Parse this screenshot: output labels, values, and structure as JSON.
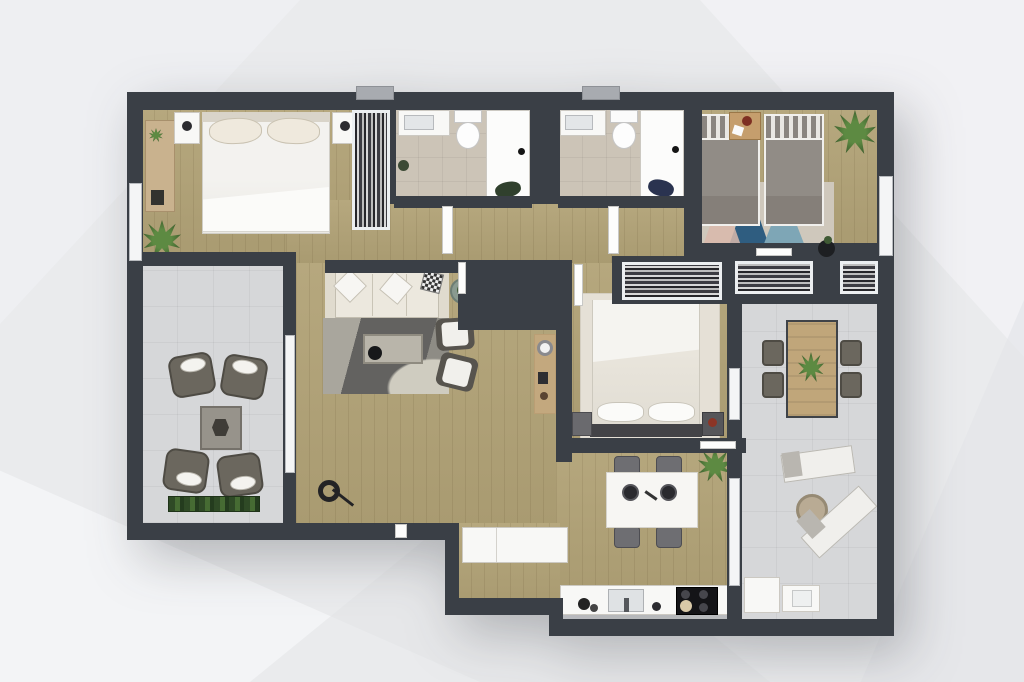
{
  "scene": {
    "title": "Apartment floor plan – top-down 3D render",
    "background_style": "light gray polygonal backdrop",
    "visible_text": "none"
  },
  "palette": {
    "background": "#eaebed",
    "wall": "#3a3f46",
    "wood_floor": "#b2a377",
    "bathroom_tile": "#ccc4b7",
    "balcony_tile": "#d6d7d9",
    "furniture_white": "#f8f8f6",
    "sofa_cream": "#ece8de",
    "bed_gray": "#918c86",
    "accent_red": "#8c3526",
    "plant_green": "#4a7a3a",
    "rug_dark_gray": "#636260",
    "rug_blue": "#2f5d80",
    "rug_teal": "#7ea6b6",
    "rug_pink": "#d9b9ab",
    "kitchen_cooktop": "#141417"
  },
  "rooms": [
    {
      "id": "master-bedroom",
      "name": "Master bedroom",
      "floor": "wood",
      "furniture": [
        "double bed",
        "two nightstands with lamps",
        "desk",
        "potted plant",
        "wardrobe"
      ]
    },
    {
      "id": "bathroom-1",
      "name": "Bathroom 1",
      "floor": "beige tile",
      "furniture": [
        "sink",
        "toilet",
        "shower"
      ]
    },
    {
      "id": "bathroom-2",
      "name": "Bathroom 2",
      "floor": "beige tile",
      "furniture": [
        "sink",
        "toilet",
        "shower"
      ]
    },
    {
      "id": "bedroom-twin",
      "name": "Twin bedroom",
      "floor": "wood",
      "furniture": [
        "two single beds",
        "bedside table",
        "triangle rug",
        "potted plant"
      ]
    },
    {
      "id": "bedroom-middle",
      "name": "Middle bedroom",
      "floor": "wood",
      "furniture": [
        "double bed",
        "two nightstands",
        "red armchair",
        "rug",
        "built-in wardrobes"
      ]
    },
    {
      "id": "living-room",
      "name": "Living room",
      "floor": "wood",
      "furniture": [
        "three-seat sofa",
        "two armchairs",
        "coffee table",
        "rug",
        "round side table",
        "floor lamp"
      ]
    },
    {
      "id": "dining-area",
      "name": "Dining area",
      "floor": "wood",
      "furniture": [
        "dining table",
        "four chairs",
        "potted plant"
      ]
    },
    {
      "id": "kitchen",
      "name": "Kitchen",
      "floor": "wood",
      "furniture": [
        "counter with sink",
        "cooktop",
        "peninsula counter"
      ]
    },
    {
      "id": "balcony-left",
      "name": "Left balcony",
      "floor": "gray tile",
      "furniture": [
        "four wicker armchairs",
        "square table",
        "planter box"
      ]
    },
    {
      "id": "terrace-right",
      "name": "Right terrace",
      "floor": "gray tile",
      "furniture": [
        "outdoor dining table",
        "four chairs",
        "two sun loungers",
        "round table",
        "appliance units"
      ]
    }
  ]
}
